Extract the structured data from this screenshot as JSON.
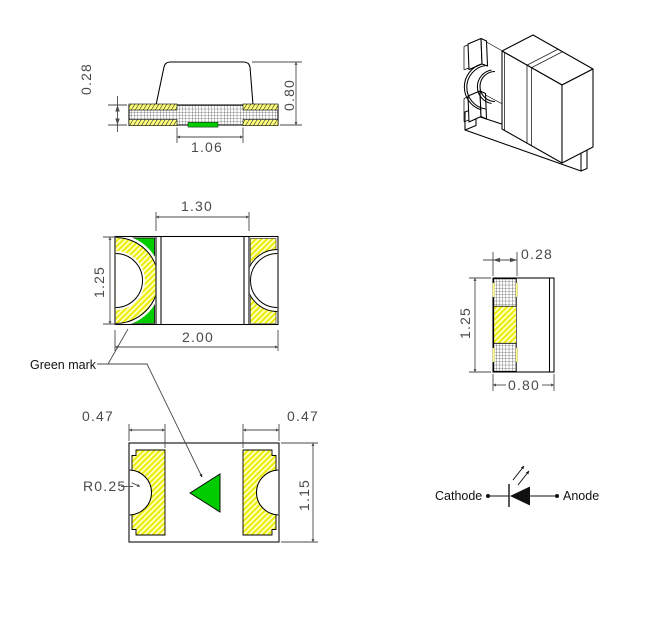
{
  "colors": {
    "green_mark": "#00CC00",
    "terminal_yellow": "#ECEC00",
    "pad_background": "#FFFFC2",
    "line": "#000000",
    "dimension": "#4A4A4A"
  },
  "side_view": {
    "substrate_thickness": "0.28",
    "total_height": "0.80",
    "bottom_terminal_span": "1.06"
  },
  "top_view": {
    "body_width": "1.30",
    "height": "1.25",
    "total_width": "2.00"
  },
  "end_view": {
    "terminal_width": "0.28",
    "height": "1.25",
    "width": "0.80"
  },
  "bottom_view": {
    "left_pad_width": "0.47",
    "right_pad_width": "0.47",
    "notch_radius": "R0.25",
    "height": "1.15"
  },
  "labels": {
    "green_mark": "Green mark",
    "cathode": "Cathode",
    "anode": "Anode"
  }
}
